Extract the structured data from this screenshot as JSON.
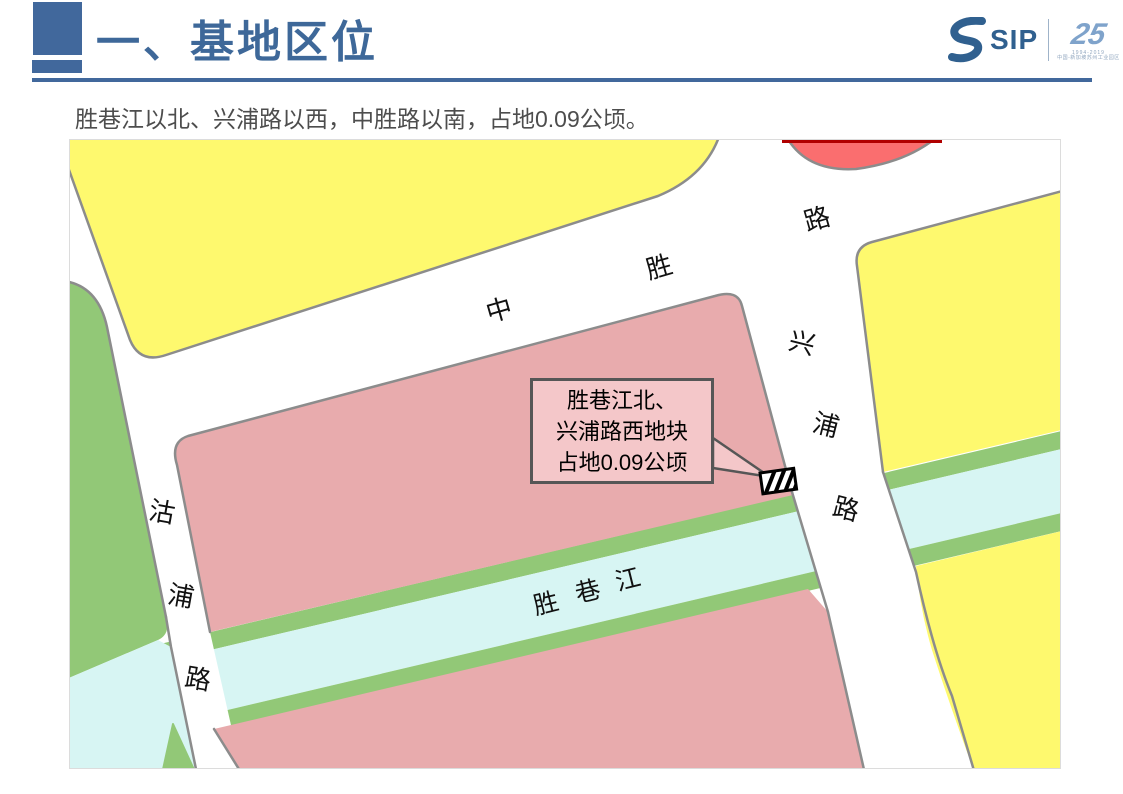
{
  "header": {
    "title": "一、基地区位"
  },
  "logo": {
    "text": "SIP",
    "anniversary": "25",
    "years": "1994-2019",
    "org": "中国-新加坡苏州工业园区"
  },
  "subtitle": "胜巷江以北、兴浦路以西，中胜路以南，占地0.09公顷。",
  "map": {
    "labels": [
      {
        "text": "中"
      },
      {
        "text": "胜"
      },
      {
        "text": "路"
      },
      {
        "text": "兴"
      },
      {
        "text": "浦"
      },
      {
        "text": "路"
      },
      {
        "text": "沽"
      },
      {
        "text": "浦"
      },
      {
        "text": "路"
      },
      {
        "text": "胜"
      },
      {
        "text": "巷"
      },
      {
        "text": "江"
      }
    ],
    "callout": {
      "line1": "胜巷江北、",
      "line2": "兴浦路西地块",
      "line3": "占地0.09公顷"
    },
    "colors": {
      "header_blue": "#41689C",
      "parcel_pink": "#E8ABAD",
      "parcel_yellow": "#FEF96E",
      "parcel_green": "#92C877",
      "parcel_red": "#FA6E6F",
      "red_edge": "#B00000",
      "water_cyan": "#D7F5F3",
      "road_outline": "#8C8C8C",
      "callout_fill": "#F4C7C9"
    }
  }
}
